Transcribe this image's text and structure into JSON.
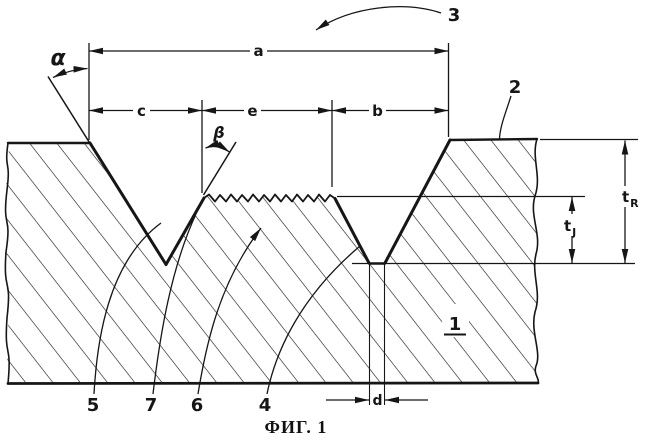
{
  "figure": {
    "caption": "ФИГ. 1",
    "dimensions": {
      "a": "a",
      "b": "b",
      "c": "c",
      "d": "d",
      "e": "e"
    },
    "angles": {
      "alpha": "α",
      "beta": "β"
    },
    "thickness": {
      "t_r": {
        "base": "t",
        "sub": "R"
      },
      "t_j": {
        "base": "t",
        "sub": "J"
      }
    },
    "references": {
      "r1": "1",
      "r2": "2",
      "r3": "3",
      "r4": "4",
      "r5": "5",
      "r6": "6",
      "r7": "7"
    },
    "colors": {
      "ink": "#161616",
      "background": "#ffffff"
    }
  }
}
